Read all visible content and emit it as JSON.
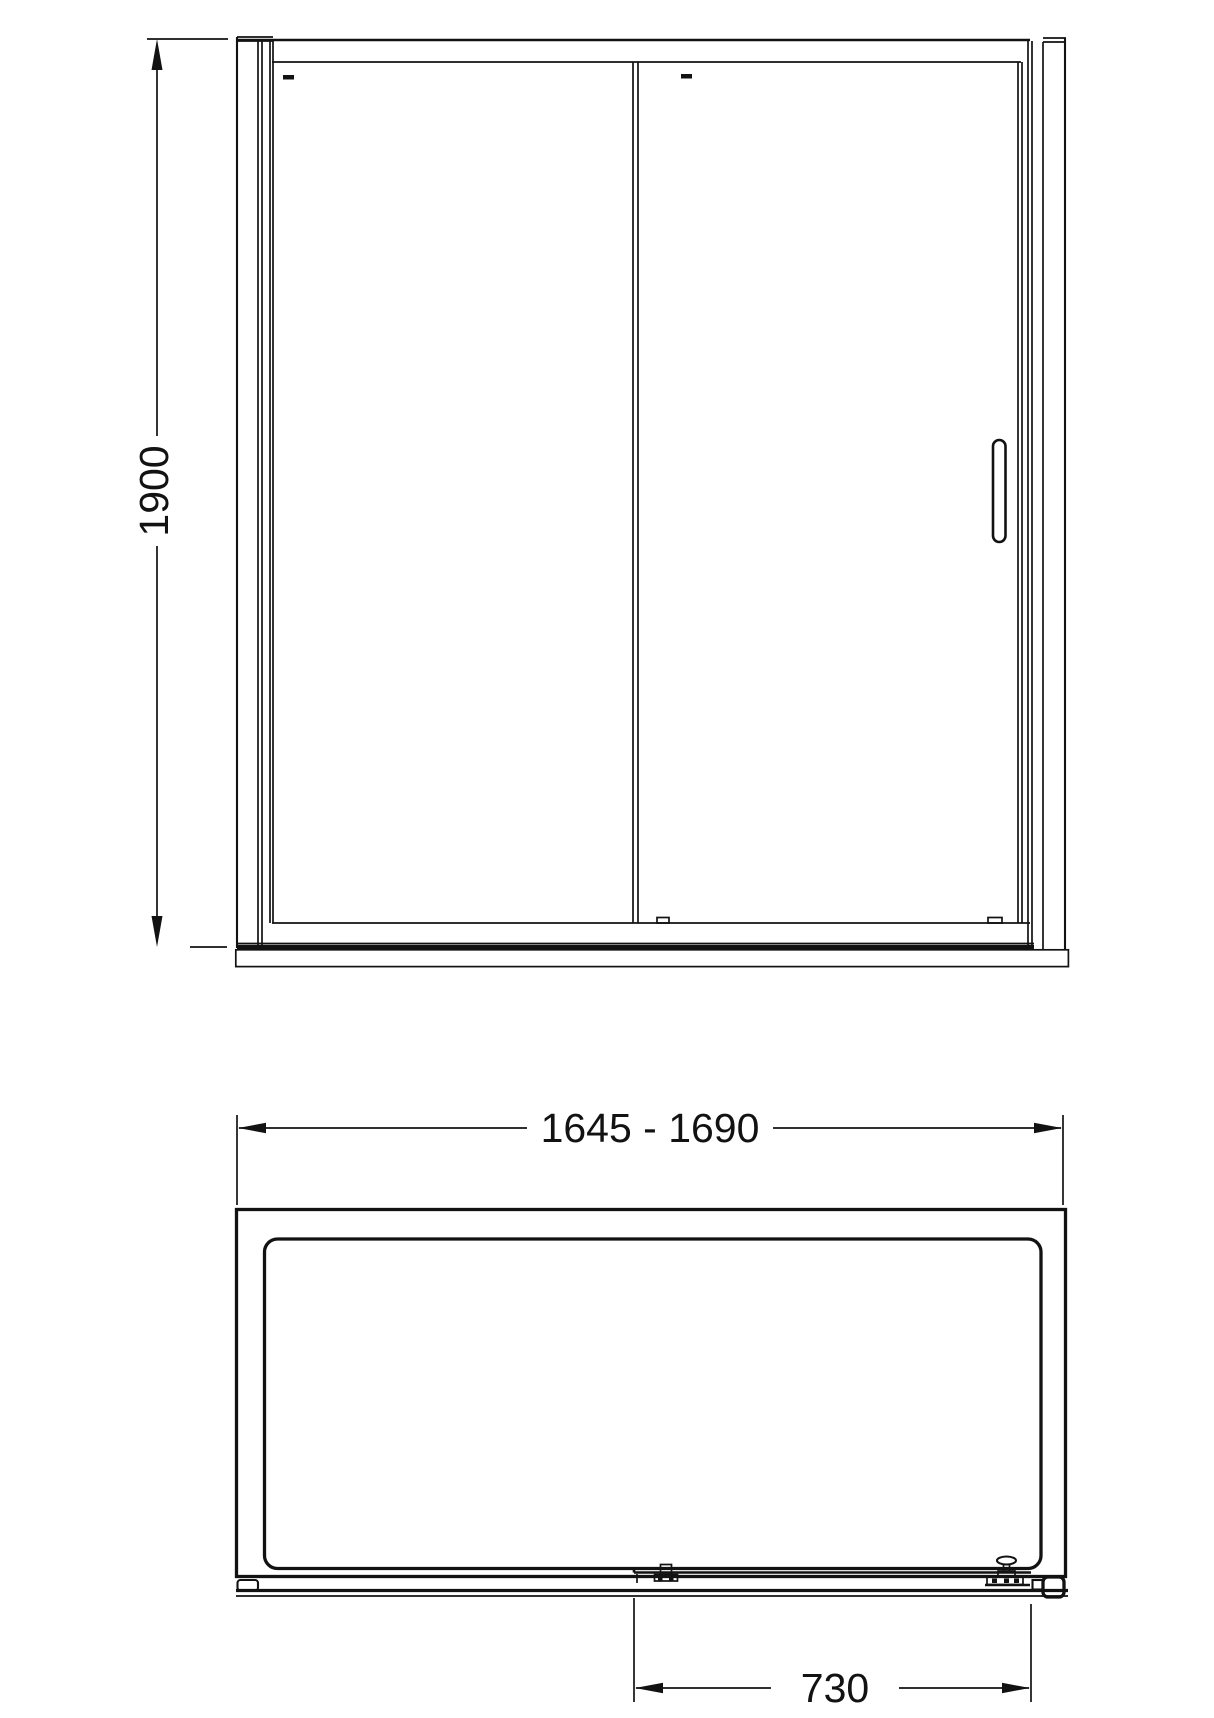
{
  "front_view": {
    "height_dimension": {
      "label": "1900"
    }
  },
  "plan_view": {
    "width_dimension": {
      "label": "1645 - 1690"
    },
    "door_opening_dimension": {
      "label": "730"
    }
  },
  "colors": {
    "line": "#121212",
    "background": "#ffffff"
  }
}
